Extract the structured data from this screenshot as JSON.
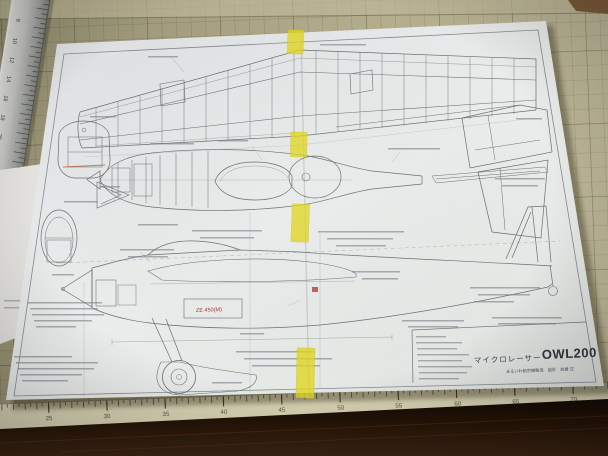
{
  "plan": {
    "title_block": {
      "series_name": "マイクロレーサー",
      "model_code": "OWL200",
      "maker_line": "まるいわ航空機製造　設計　岩倉 正"
    },
    "labels": {
      "red_power_label": "ZE 450(M)"
    }
  },
  "mat_scale": {
    "numbers": [
      "25",
      "30",
      "35",
      "40",
      "45",
      "50",
      "55",
      "60",
      "65",
      "70"
    ]
  },
  "metal_ruler": {
    "numbers": [
      "8",
      "10",
      "12",
      "14",
      "16",
      "18",
      "20"
    ]
  }
}
